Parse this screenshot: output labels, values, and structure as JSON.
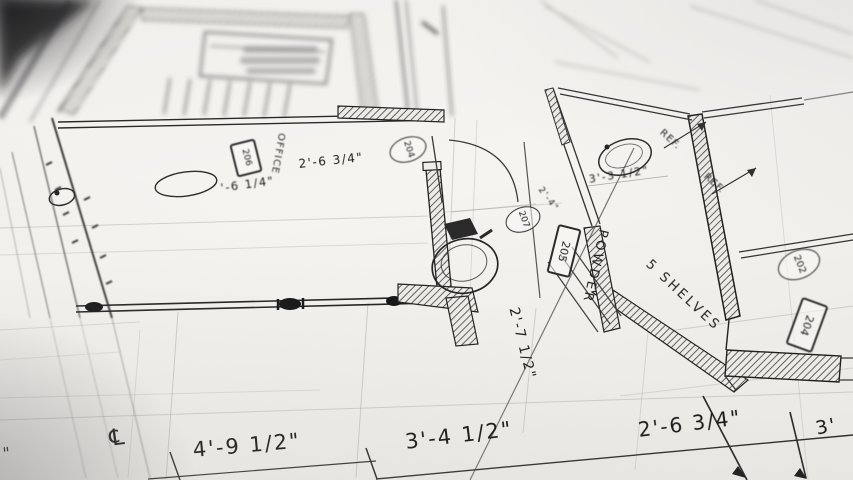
{
  "plan": {
    "rooms": {
      "office": "OFFICE",
      "powder": "POWDER"
    },
    "notes": {
      "shelves": "5 SHELVES",
      "ref_upper": "REF.",
      "ref_lower": "REF."
    },
    "tags": {
      "box_office": "206",
      "box_stair": "205",
      "box_right": "204",
      "circle_upper": "204",
      "circle_center": "207",
      "circle_right": "202"
    },
    "dimensions": {
      "office_width": "2'-6 3/4\"",
      "office_partial": "'-6 1/4\"",
      "sink_room": "3'-3 1/2\"",
      "stair_small": "2'-4\"",
      "vertical_center": "2'-7 1/2\"",
      "bottom": [
        "4'-9 1/2\"",
        "3'-4 1/2\"",
        "2'-6 3/4\"",
        "3'"
      ],
      "centerline_symbol": "℄",
      "left_edge_tick": "\""
    }
  },
  "colors": {
    "paper": "#f2f0ec",
    "ink": "#1b1b1b"
  }
}
